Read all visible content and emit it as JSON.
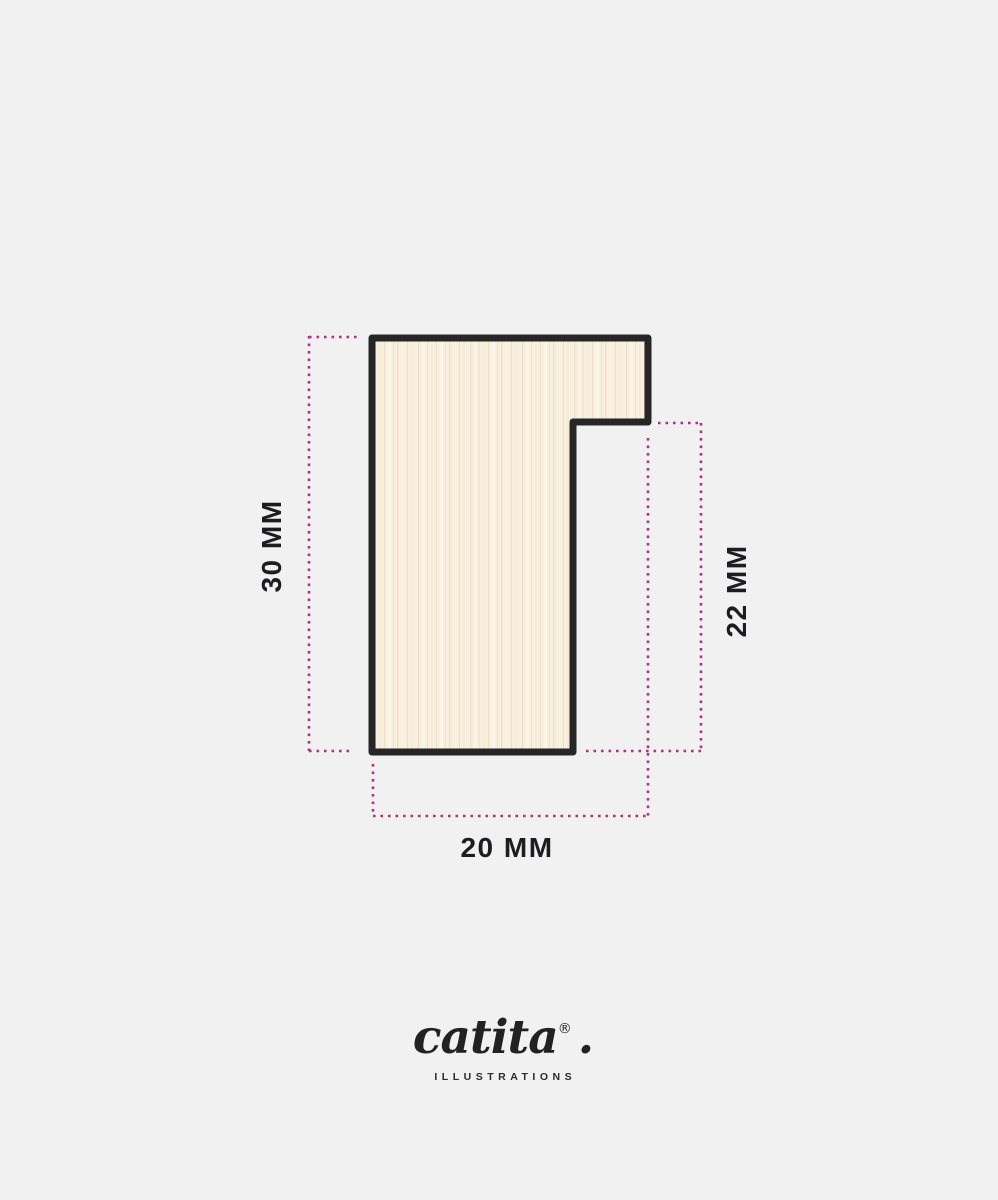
{
  "diagram": {
    "type": "frame-moulding-profile-cross-section",
    "colors": {
      "background": "#f1f1f2",
      "profile_outline": "#262626",
      "wood_base": "#f8efde",
      "dimension_line": "#b03180",
      "label_text": "#1d1d1f"
    },
    "dimensions": {
      "height": {
        "label": "30 MM"
      },
      "rabbet_height": {
        "label": "22 MM"
      },
      "width": {
        "label": "20 MM"
      }
    }
  },
  "footer": {
    "brand": "catita",
    "registered_mark": "®",
    "period": ".",
    "tagline": "ILLUSTRATIONS"
  }
}
